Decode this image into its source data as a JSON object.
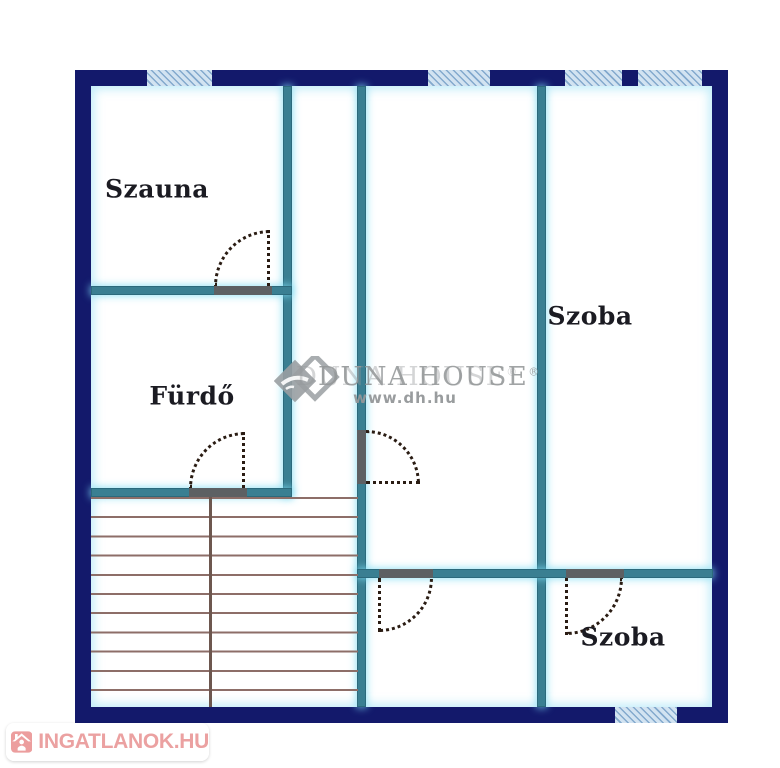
{
  "rooms": {
    "szauna": {
      "label": "Szauna"
    },
    "furdo": {
      "label": "Fürdő"
    },
    "szoba_top": {
      "label": "Szoba"
    },
    "szoba_bottom": {
      "label": "Szoba"
    }
  },
  "watermark": {
    "brand": "DUNA HOUSE",
    "registered_mark": "®",
    "website": "www.dh.hu"
  },
  "footer_logo": {
    "text": "INGATLANOK.HU",
    "icon": "house-icon"
  },
  "colors": {
    "outer_wall": "#13196b",
    "inner_wall": "#3a7f92",
    "window_fill": "#d2e3f1",
    "window_stripe": "#83a9cd",
    "door_swing_dots": "#2a1c13",
    "door_opening": "#5d6063",
    "stairs_lines": "#8d6e68",
    "room_label_text": "#1b1b22",
    "watermark_gray": "#979a9c",
    "logo_red": "#eba1a1"
  }
}
